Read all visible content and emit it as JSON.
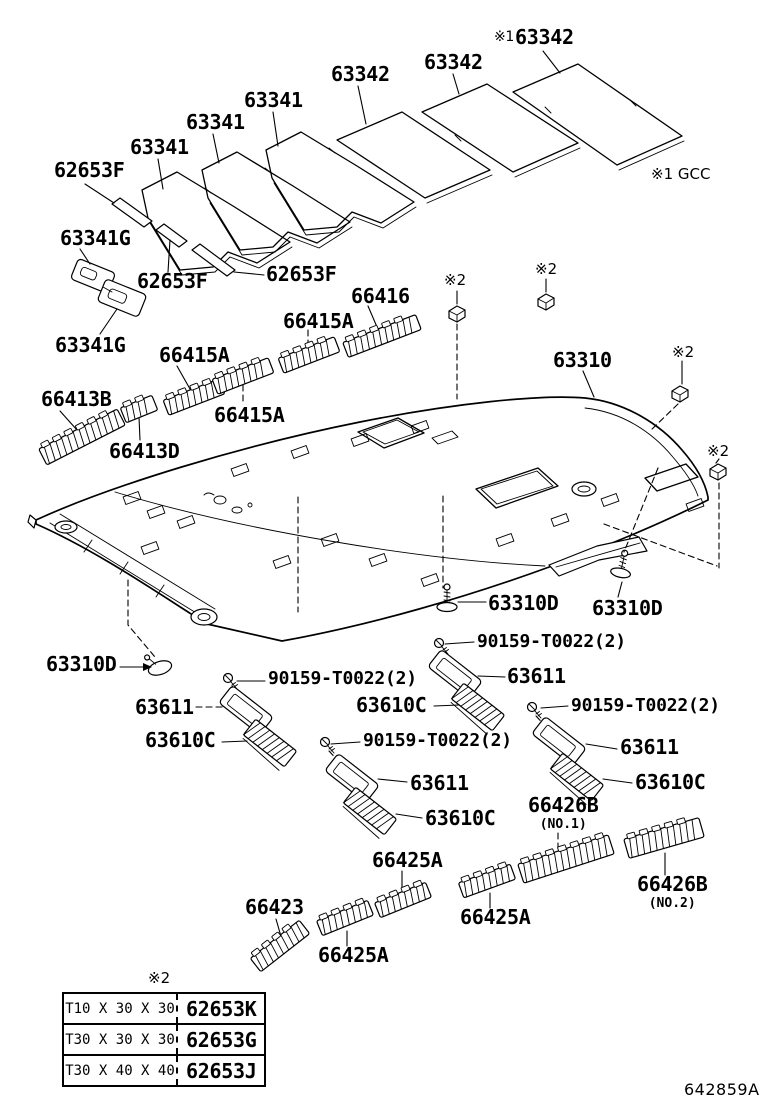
{
  "diagram": {
    "drawing_code": "642859A",
    "region_note": "※1 GCC",
    "star2_markers": [
      "※2",
      "※2",
      "※2",
      "※2"
    ],
    "table_star": "※2"
  },
  "labels": [
    {
      "id": "63342-1",
      "text": "63342"
    },
    {
      "id": "63342-2",
      "text": "63342"
    },
    {
      "id": "63342-3",
      "prefix": "※1",
      "text": "63342"
    },
    {
      "id": "63341-1",
      "text": "63341"
    },
    {
      "id": "63341-2",
      "text": "63341"
    },
    {
      "id": "63341-3",
      "text": "63341"
    },
    {
      "id": "62653F-1",
      "text": "62653F"
    },
    {
      "id": "63341G-1",
      "text": "63341G"
    },
    {
      "id": "62653F-2",
      "text": "62653F"
    },
    {
      "id": "62653F-3",
      "text": "62653F"
    },
    {
      "id": "63341G-2",
      "text": "63341G"
    },
    {
      "id": "66416",
      "text": "66416"
    },
    {
      "id": "66415A-1",
      "text": "66415A"
    },
    {
      "id": "66415A-2",
      "text": "66415A"
    },
    {
      "id": "66415A-3",
      "text": "66415A"
    },
    {
      "id": "66413B",
      "text": "66413B"
    },
    {
      "id": "66413D",
      "text": "66413D"
    },
    {
      "id": "63310",
      "text": "63310"
    },
    {
      "id": "63310D-1",
      "text": "63310D"
    },
    {
      "id": "63310D-2",
      "text": "63310D"
    },
    {
      "id": "63310D-3",
      "text": "63310D"
    },
    {
      "id": "90159-1",
      "text": "90159-T0022(2)"
    },
    {
      "id": "90159-2",
      "text": "90159-T0022(2)"
    },
    {
      "id": "90159-3",
      "text": "90159-T0022(2)"
    },
    {
      "id": "90159-4",
      "text": "90159-T0022(2)"
    },
    {
      "id": "63611-1",
      "text": "63611"
    },
    {
      "id": "63611-2",
      "text": "63611"
    },
    {
      "id": "63611-3",
      "text": "63611"
    },
    {
      "id": "63611-4",
      "text": "63611"
    },
    {
      "id": "63610C-1",
      "text": "63610C"
    },
    {
      "id": "63610C-2",
      "text": "63610C"
    },
    {
      "id": "63610C-3",
      "text": "63610C"
    },
    {
      "id": "63610C-4",
      "text": "63610C"
    },
    {
      "id": "66426B-1",
      "text": "66426B",
      "sub": "(NO.1)"
    },
    {
      "id": "66426B-2",
      "text": "66426B",
      "sub": "(NO.2)"
    },
    {
      "id": "66425A-1",
      "text": "66425A"
    },
    {
      "id": "66425A-2",
      "text": "66425A"
    },
    {
      "id": "66423",
      "text": "66423"
    },
    {
      "id": "66425A-3",
      "text": "66425A"
    }
  ],
  "thickness_table": {
    "rows": [
      {
        "size": "T10 X 30 X 30",
        "part": "62653K"
      },
      {
        "size": "T30 X 30 X 30",
        "part": "62653G"
      },
      {
        "size": "T30 X 40 X 40",
        "part": "62653J"
      }
    ]
  }
}
